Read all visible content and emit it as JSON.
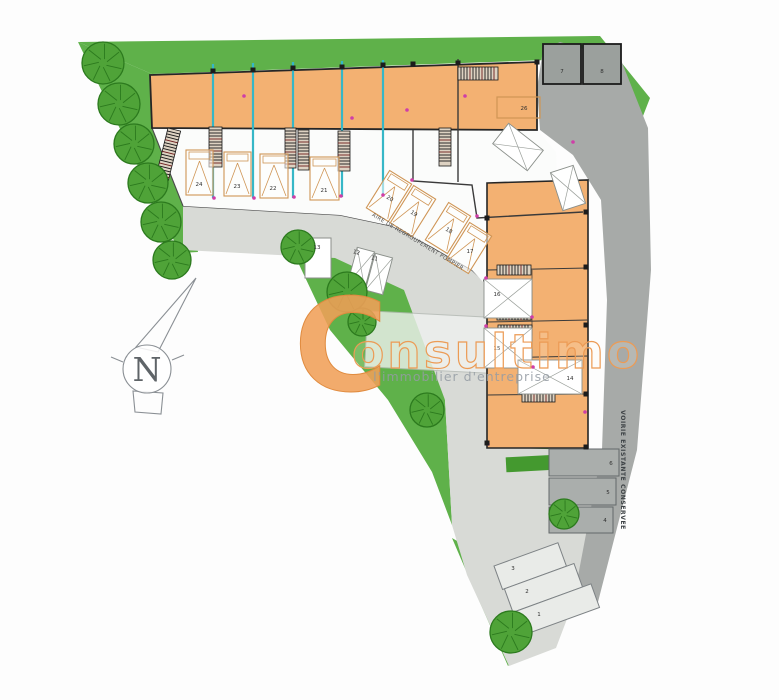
{
  "watermark": {
    "initial": "C",
    "rest": "onsultimo",
    "full_name": "Consultimo",
    "tagline": "l'immobilier d'entreprise",
    "color": "#ef9f5a"
  },
  "road_labels": {
    "fire_lane": "AIRE DE REGROUPEMENT POMPIER",
    "existing_road": "VOIRIE EXISTANTE CONSERVEE"
  },
  "compass": {
    "north": "N"
  },
  "palette": {
    "green": "#5fb14a",
    "tree_fill": "#4fa338",
    "tree_stroke": "#2c7a1e",
    "hedge": "#44992f",
    "building_orange": "#f3b172",
    "stall_orange": "#cf9555",
    "road_light": "#d8dad6",
    "road_dark": "#a7aaa8",
    "teal_wall": "#36b7c7",
    "outline": "#2d2d2d",
    "accent_pink": "#cf3ea8"
  },
  "unit_labels": [
    {
      "text": "24",
      "x": 199,
      "y": 186
    },
    {
      "text": "23",
      "x": 237,
      "y": 188
    },
    {
      "text": "22",
      "x": 273,
      "y": 190
    },
    {
      "text": "21",
      "x": 324,
      "y": 192
    },
    {
      "text": "20",
      "x": 389,
      "y": 200,
      "rot": 32
    },
    {
      "text": "19",
      "x": 413,
      "y": 215,
      "rot": 32
    },
    {
      "text": "18",
      "x": 448,
      "y": 232,
      "rot": 32
    },
    {
      "text": "17",
      "x": 470,
      "y": 253
    },
    {
      "text": "16",
      "x": 497,
      "y": 296
    },
    {
      "text": "15",
      "x": 497,
      "y": 350
    },
    {
      "text": "14",
      "x": 570,
      "y": 380
    },
    {
      "text": "13",
      "x": 317,
      "y": 249
    },
    {
      "text": "12",
      "x": 356,
      "y": 254,
      "rot": 15
    },
    {
      "text": "11",
      "x": 374,
      "y": 260,
      "rot": 15
    },
    {
      "text": "26",
      "x": 524,
      "y": 110
    },
    {
      "text": "7",
      "x": 562,
      "y": 73
    },
    {
      "text": "8",
      "x": 602,
      "y": 73
    },
    {
      "text": "6",
      "x": 611,
      "y": 465
    },
    {
      "text": "5",
      "x": 608,
      "y": 494
    },
    {
      "text": "4",
      "x": 605,
      "y": 522
    },
    {
      "text": "3",
      "x": 513,
      "y": 570
    },
    {
      "text": "2",
      "x": 527,
      "y": 593
    },
    {
      "text": "1",
      "x": 539,
      "y": 616
    }
  ],
  "trees": [
    {
      "x": 103,
      "y": 63,
      "r": 21
    },
    {
      "x": 119,
      "y": 104,
      "r": 21
    },
    {
      "x": 134,
      "y": 144,
      "r": 20
    },
    {
      "x": 148,
      "y": 183,
      "r": 20
    },
    {
      "x": 161,
      "y": 222,
      "r": 20
    },
    {
      "x": 172,
      "y": 260,
      "r": 19
    },
    {
      "x": 298,
      "y": 247,
      "r": 17
    },
    {
      "x": 347,
      "y": 292,
      "r": 20
    },
    {
      "x": 362,
      "y": 322,
      "r": 14
    },
    {
      "x": 427,
      "y": 410,
      "r": 17
    },
    {
      "x": 564,
      "y": 514,
      "r": 15
    },
    {
      "x": 511,
      "y": 632,
      "r": 21
    }
  ]
}
